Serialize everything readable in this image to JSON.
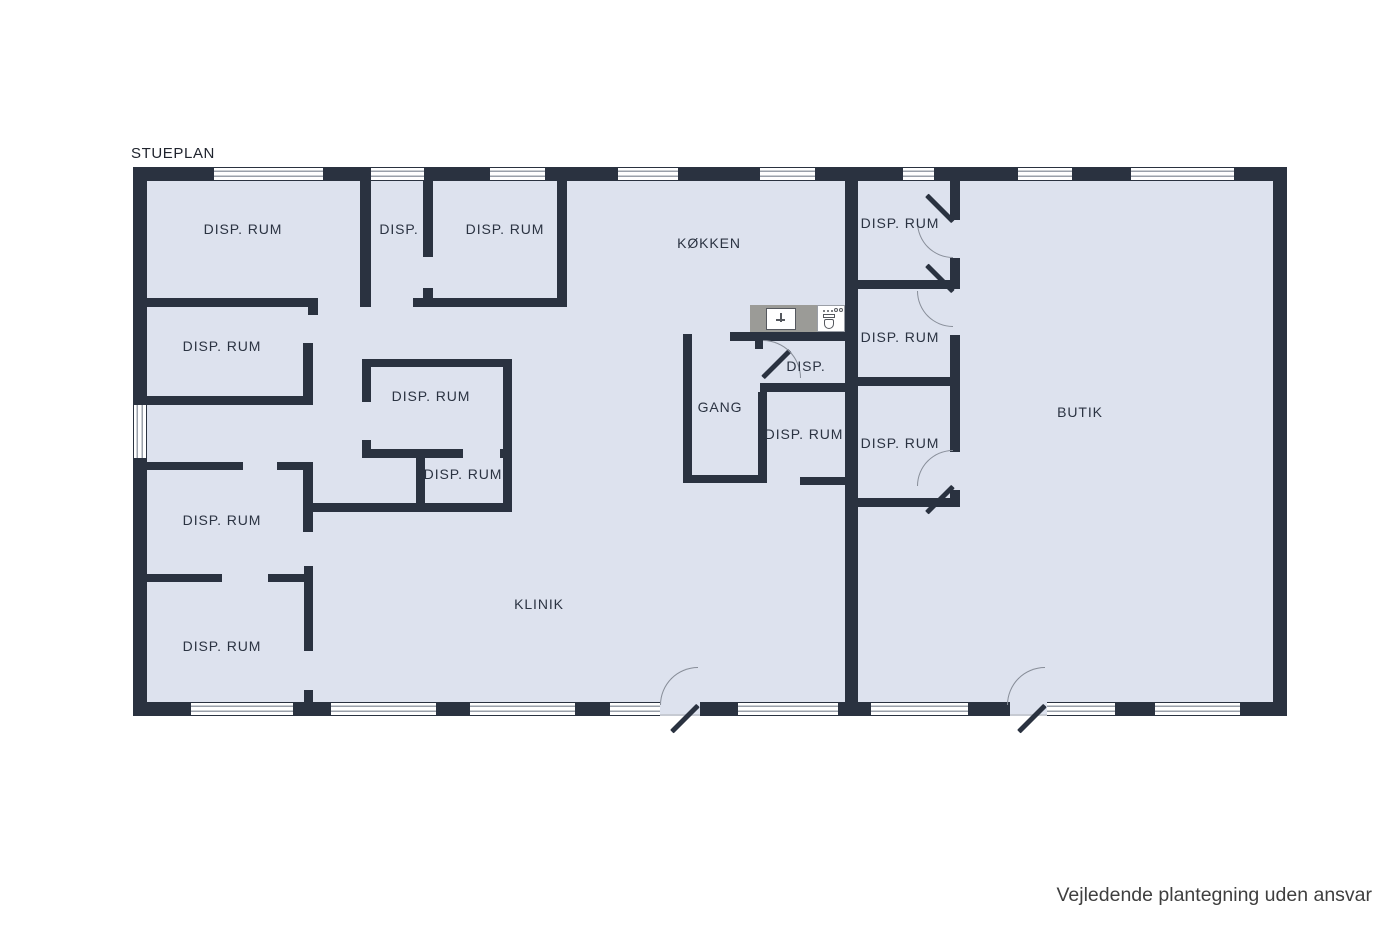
{
  "page": {
    "title": "STUEPLAN",
    "disclaimer": "Vejledende plantegning uden ansvar"
  },
  "colors": {
    "wall": "#2a3240",
    "floor": "#dde2ee",
    "window_stripe": "#9aa0aa",
    "counter": "#9b9b97",
    "door_arc": "#878d98",
    "label": "#2b3342"
  },
  "fixtures": {
    "sink": "kitchen-sink-with-faucet",
    "toilet": "toilet"
  },
  "rooms": [
    {
      "id": "disp-rum-top-left",
      "label": "DISP. RUM"
    },
    {
      "id": "disp-top",
      "label": "DISP."
    },
    {
      "id": "disp-rum-top-mid",
      "label": "DISP. RUM"
    },
    {
      "id": "koekken",
      "label": "KØKKEN"
    },
    {
      "id": "disp-rum-right-1",
      "label": "DISP. RUM"
    },
    {
      "id": "disp-rum-left-2",
      "label": "DISP. RUM"
    },
    {
      "id": "disp-rum-right-2",
      "label": "DISP. RUM"
    },
    {
      "id": "disp-rum-center",
      "label": "DISP. RUM"
    },
    {
      "id": "gang",
      "label": "GANG"
    },
    {
      "id": "disp-small",
      "label": "DISP."
    },
    {
      "id": "butik",
      "label": "BUTIK"
    },
    {
      "id": "disp-rum-center-2",
      "label": "DISP. RUM"
    },
    {
      "id": "disp-rum-right-3",
      "label": "DISP. RUM"
    },
    {
      "id": "disp-rum-center-small",
      "label": "DISP. RUM"
    },
    {
      "id": "disp-rum-left-3",
      "label": "DISP. RUM"
    },
    {
      "id": "klinik",
      "label": "KLINIK"
    },
    {
      "id": "disp-rum-left-4",
      "label": "DISP. RUM"
    }
  ]
}
